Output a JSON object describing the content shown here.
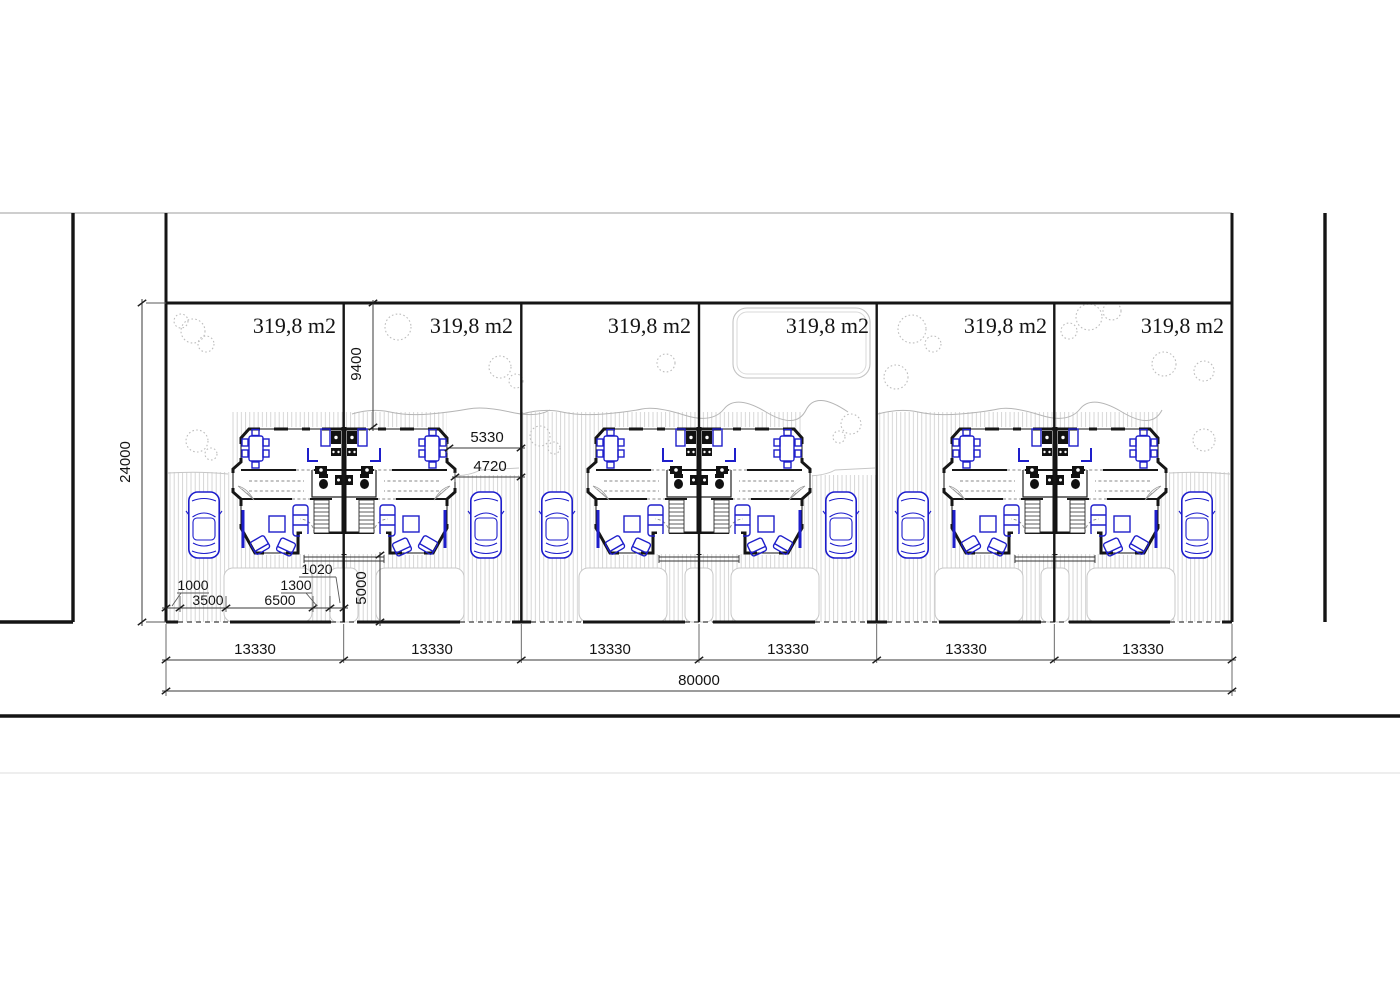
{
  "site_plan": {
    "lots": [
      {
        "area_label": "319,8 m2",
        "width_label": "13330"
      },
      {
        "area_label": "319,8 m2",
        "width_label": "13330"
      },
      {
        "area_label": "319,8 m2",
        "width_label": "13330"
      },
      {
        "area_label": "319,8 m2",
        "width_label": "13330"
      },
      {
        "area_label": "319,8 m2",
        "width_label": "13330"
      },
      {
        "area_label": "319,8 m2",
        "width_label": "13330"
      }
    ],
    "dimensions": {
      "total_width": "80000",
      "site_depth": "24000",
      "rear_garden_depth": "9400",
      "front_yard_depth": "5000",
      "side_offset_upper": "5330",
      "side_offset_lower": "4720",
      "gate_width": "1000",
      "driveway_width": "3500",
      "front_pad_width": "6500",
      "walkway_width": "1300",
      "entry_step_width": "1020"
    }
  },
  "colors": {
    "ink": "#161616",
    "dimension_line": "#3a3a3a",
    "furniture_blue": "#1e1ecb",
    "car_blue": "#1d1dcc",
    "hatch_gray": "#cccccc",
    "tree_gray": "#bdbdbd"
  }
}
